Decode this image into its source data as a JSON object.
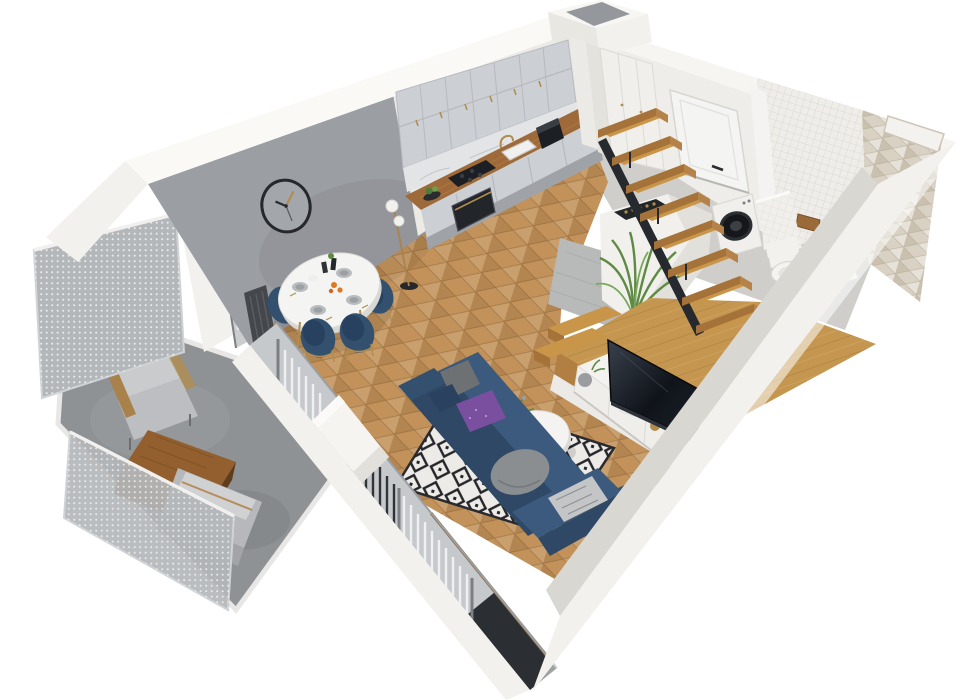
{
  "meta": {
    "title": "3D apartment floor plan cutaway render",
    "view": "isometric perspective from above",
    "background": "#ffffff",
    "clock_time_shown": "10:10"
  },
  "palette": {
    "wall_white": "#f2f1ed",
    "wall_top": "#faf9f6",
    "wall_gray": "#9b9ea3",
    "wall_inner_gray": "#d9d7d2",
    "floor_wood": "#c2925a",
    "floor_platform": "#c4964f",
    "floor_concrete": "#8f9295",
    "floor_tile_gray": "#b7bab9",
    "cabinet_gray": "#ccd0d4",
    "counter_wood": "#9e6a3a",
    "marble": "#e3e4e6",
    "sofa_navy": "#3c5a7d",
    "sofa_navy_dark": "#2e4866",
    "chair_navy": "#33506f",
    "pillow_purple": "#7b4fa0",
    "pillow_gray": "#8b8e91",
    "rug_base": "#ecebe7",
    "rug_pattern": "#26262a",
    "mesh_gray": "#b4b7ba",
    "tv_black": "#15181d",
    "stair_wood": "#c89549",
    "gold": "#b08d4f",
    "plant_green": "#5e8a44",
    "door_white": "#f4f4f2",
    "tile_white": "#efede9",
    "chevron_tile": "#d9d2c4",
    "radiator_dark": "#44484d",
    "table_white": "#f4f4f2",
    "appliance_black": "#1c1f23",
    "washer_white": "#f0efec",
    "balcony_table_wood": "#935f2e",
    "glass": "#c6c9cc"
  },
  "rooms": {
    "kitchen": {
      "label": "kitchen",
      "furniture": [
        "upper-cabinets",
        "base-cabinets",
        "wood-countertop",
        "marble-backsplash",
        "cooktop",
        "oven",
        "sink",
        "coffee-machine",
        "tall-pantry"
      ]
    },
    "dining_area": {
      "label": "dining area",
      "furniture": [
        "oval-dining-table",
        "navy-chair-1",
        "navy-chair-2",
        "navy-chair-3",
        "navy-chair-4",
        "floor-lamp",
        "wall-clock",
        "radiator"
      ]
    },
    "living_room": {
      "label": "living room",
      "furniture": [
        "corner-sofa",
        "diamond-rug",
        "round-coffee-table",
        "tv-sideboard",
        "tv",
        "pillows"
      ]
    },
    "hallway": {
      "label": "hallway",
      "furniture": [
        "entrance-door",
        "tall-cabinet",
        "floating-stairs",
        "wood-platform",
        "wine-storage-island",
        "palm-plant"
      ]
    },
    "bathroom": {
      "label": "bathroom",
      "furniture": [
        "washing-machine",
        "toilet",
        "sink-vanity",
        "shower-chevron-wall",
        "wall-niche",
        "wood-mirror-cabinet"
      ]
    },
    "balcony": {
      "label": "balcony",
      "furniture": [
        "mesh-railing",
        "lounge-armchair",
        "wood-coffee-table",
        "bench"
      ]
    }
  }
}
